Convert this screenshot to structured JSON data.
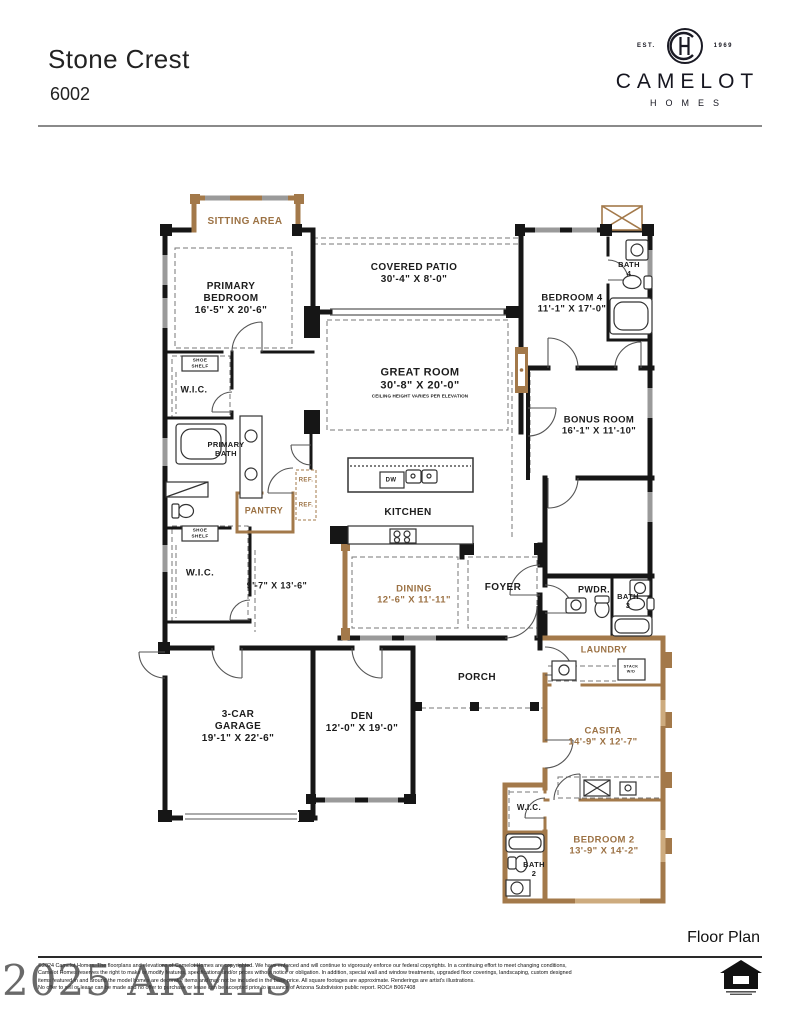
{
  "header": {
    "title": "Stone Crest",
    "model": "6002"
  },
  "logo": {
    "est": "EST.",
    "year": "1969",
    "brand": "CAMELOT",
    "sub": "HOMES"
  },
  "colors": {
    "brown": "#9c7244",
    "black": "#1c1c1c",
    "wall_black": "#161616",
    "wall_brown": "#a3794a",
    "window_gray": "#9a9a9a"
  },
  "plan": {
    "labels": [
      {
        "id": "sitting-area",
        "lines": [
          "SITTING AREA"
        ],
        "x": 245,
        "y": 222,
        "color": "brown",
        "size": 10
      },
      {
        "id": "primary-bedroom",
        "lines": [
          "PRIMARY",
          "BEDROOM",
          "16'-5\" X 20'-6\""
        ],
        "x": 231,
        "y": 299,
        "color": "black",
        "size": 10
      },
      {
        "id": "covered-patio",
        "lines": [
          "COVERED PATIO",
          "30'-4\" X 8'-0\""
        ],
        "x": 414,
        "y": 274,
        "color": "black",
        "size": 10
      },
      {
        "id": "bath-4",
        "lines": [
          "BATH",
          "4"
        ],
        "x": 629,
        "y": 269,
        "color": "black",
        "size": 7.5
      },
      {
        "id": "bedroom-4",
        "lines": [
          "BEDROOM 4",
          "11'-1\" X 17'-0\""
        ],
        "x": 572,
        "y": 304,
        "color": "black",
        "size": 9.5
      },
      {
        "id": "great-room",
        "lines": [
          "GREAT ROOM",
          "30'-8\" X 20'-0\""
        ],
        "sub": "CEILING HEIGHT VARIES PER ELEVATION",
        "x": 420,
        "y": 383,
        "color": "black",
        "size": 11
      },
      {
        "id": "bonus-room",
        "lines": [
          "BONUS ROOM",
          "16'-1\" X 11'-10\""
        ],
        "x": 599,
        "y": 426,
        "color": "black",
        "size": 9.5
      },
      {
        "id": "shoe-shelf-1",
        "lines": [
          "SHOE",
          "SHELF"
        ],
        "x": 200,
        "y": 363,
        "color": "black",
        "size": 4.6
      },
      {
        "id": "wic-1",
        "lines": [
          "W.I.C."
        ],
        "x": 194,
        "y": 390,
        "color": "black",
        "size": 9
      },
      {
        "id": "primary-bath",
        "lines": [
          "PRIMARY",
          "BATH"
        ],
        "x": 226,
        "y": 449,
        "color": "black",
        "size": 7.5
      },
      {
        "id": "ref-1",
        "lines": [
          "REF."
        ],
        "x": 306,
        "y": 481,
        "color": "brown",
        "size": 6
      },
      {
        "id": "ref-2",
        "lines": [
          "REF."
        ],
        "x": 306,
        "y": 506,
        "color": "brown",
        "size": 6
      },
      {
        "id": "pantry",
        "lines": [
          "PANTRY"
        ],
        "x": 264,
        "y": 511,
        "color": "brown",
        "size": 9
      },
      {
        "id": "dw",
        "lines": [
          "DW"
        ],
        "x": 391,
        "y": 481,
        "color": "black",
        "size": 6
      },
      {
        "id": "kitchen",
        "lines": [
          "KITCHEN"
        ],
        "x": 408,
        "y": 513,
        "color": "black",
        "size": 10
      },
      {
        "id": "shoe-shelf-2",
        "lines": [
          "SHOE",
          "SHELF"
        ],
        "x": 200,
        "y": 533,
        "color": "black",
        "size": 4.6
      },
      {
        "id": "wic-2",
        "lines": [
          "W.I.C."
        ],
        "x": 200,
        "y": 573,
        "color": "black",
        "size": 9.5
      },
      {
        "id": "flex-space-dims",
        "lines": [
          "9'-7\" X 13'-6\""
        ],
        "x": 277,
        "y": 586,
        "color": "black",
        "size": 9
      },
      {
        "id": "dining",
        "lines": [
          "DINING",
          "12'-6\" X 11'-11\""
        ],
        "x": 414,
        "y": 595,
        "color": "brown",
        "size": 9.5
      },
      {
        "id": "foyer",
        "lines": [
          "FOYER"
        ],
        "x": 503,
        "y": 588,
        "color": "black",
        "size": 10
      },
      {
        "id": "pwdr",
        "lines": [
          "PWDR."
        ],
        "x": 594,
        "y": 590,
        "color": "black",
        "size": 9
      },
      {
        "id": "bath-3",
        "lines": [
          "BATH",
          "3"
        ],
        "x": 628,
        "y": 601,
        "color": "black",
        "size": 7.5
      },
      {
        "id": "laundry",
        "lines": [
          "LAUNDRY"
        ],
        "x": 604,
        "y": 650,
        "color": "brown",
        "size": 9
      },
      {
        "id": "stack-wd",
        "lines": [
          "STACK",
          "W/D"
        ],
        "x": 631,
        "y": 669,
        "color": "black",
        "size": 3.8
      },
      {
        "id": "porch",
        "lines": [
          "PORCH"
        ],
        "x": 477,
        "y": 678,
        "color": "black",
        "size": 10
      },
      {
        "id": "garage",
        "lines": [
          "3-CAR",
          "GARAGE",
          "19'-1\" X 22'-6\""
        ],
        "x": 238,
        "y": 727,
        "color": "black",
        "size": 10
      },
      {
        "id": "den",
        "lines": [
          "DEN",
          "12'-0\" X 19'-0\""
        ],
        "x": 362,
        "y": 723,
        "color": "black",
        "size": 10
      },
      {
        "id": "casita",
        "lines": [
          "CASITA",
          "14'-9\" X 12'-7\""
        ],
        "x": 603,
        "y": 737,
        "color": "brown",
        "size": 9.5
      },
      {
        "id": "wic-3",
        "lines": [
          "W.I.C."
        ],
        "x": 529,
        "y": 808,
        "color": "black",
        "size": 8
      },
      {
        "id": "bedroom-2",
        "lines": [
          "BEDROOM 2",
          "13'-9\" X 14'-2\""
        ],
        "x": 604,
        "y": 846,
        "color": "brown",
        "size": 9.5
      },
      {
        "id": "bath-2",
        "lines": [
          "BATH",
          "2"
        ],
        "x": 534,
        "y": 869,
        "color": "black",
        "size": 7.5
      }
    ]
  },
  "footer": {
    "section_label": "Floor Plan",
    "watermark": "2025 ARMLS",
    "copyright_lines": [
      "©2024 Camelot Homes. The floorplans and elevations of Camelot Homes are copyrighted. We have enforced and will continue to vigorously enforce our federal copyrights. In a continuing effort to meet changing conditions,",
      "Camelot Homes reserves the right to make or modify features, specifications and/or prices without notice or obligation. In addition, special wall and window treatments, upgraded floor coverings, landscaping, custom designed",
      "items featured in and around the model homes are decorator items and may not be included in the base price. All square footages are approximate. Renderings are artist's illustrations.",
      "No offer to sell or lease can be made and no offer to purchase or lease can be accepted prior to issuance of Arizona Subdivision public report. ROC# B067408"
    ]
  }
}
